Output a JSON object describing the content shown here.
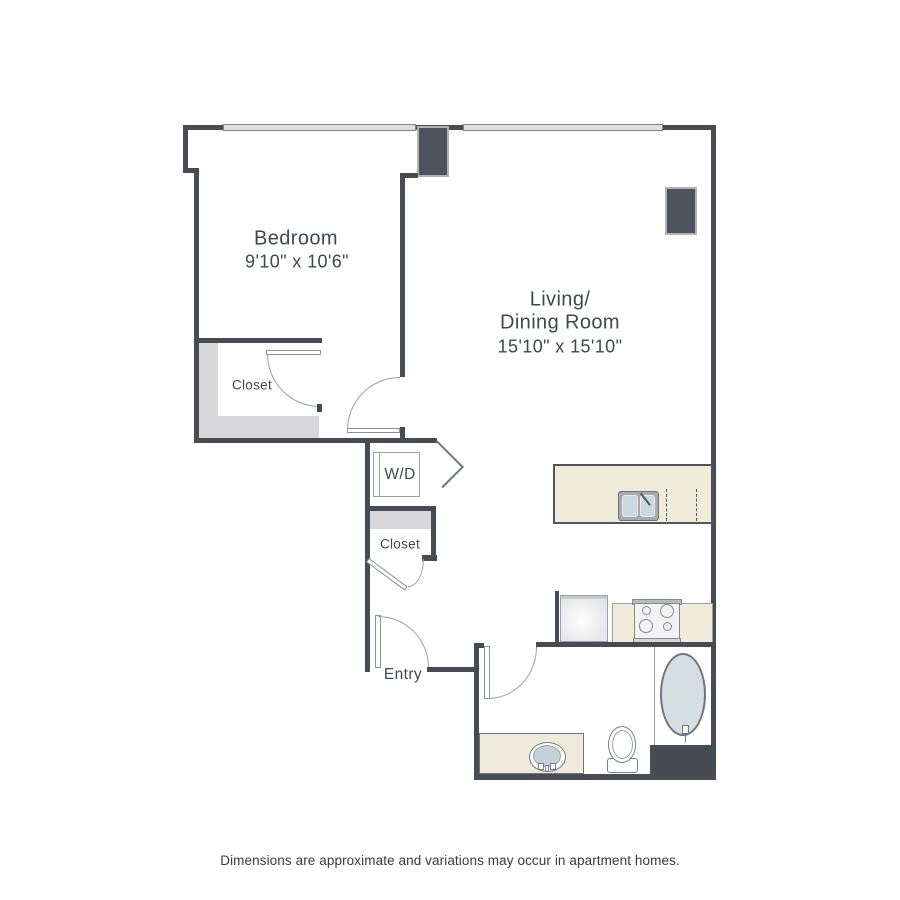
{
  "rooms": {
    "bedroom": {
      "name": "Bedroom",
      "dims": "9'10\" x 10'6\""
    },
    "living": {
      "name_line1": "Living/",
      "name_line2": "Dining Room",
      "dims": "15'10\" x 15'10\""
    },
    "bedroom_closet": {
      "name": "Closet"
    },
    "hall_closet": {
      "name": "Closet"
    },
    "washer_dryer": {
      "name": "W/D"
    },
    "entry": {
      "name": "Entry"
    }
  },
  "footer": {
    "disclaimer": "Dimensions are approximate and variations may occur in apartment homes."
  },
  "colors": {
    "wall": "#474c54",
    "window_fill": "#dcdfe1",
    "column_fill": "#4d535c",
    "closet_shading": "#d7d7d9",
    "counter_beige": "#f1ecda",
    "tub_fill": "#d4dee3",
    "sink_basin": "#ccd8e0",
    "swing_line": "#9aa0a5",
    "label_text": "#42474e"
  }
}
